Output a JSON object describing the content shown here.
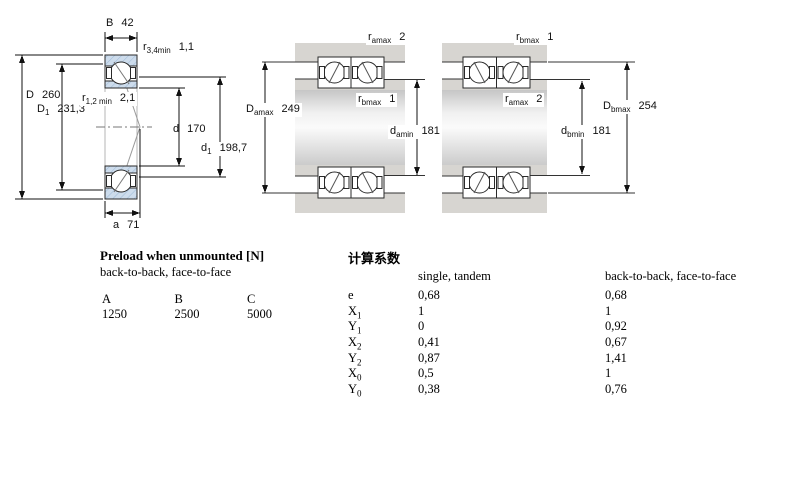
{
  "colors": {
    "ring_hatch_fill": "#cddcec",
    "ring_hatch_line": "#9cb9d6",
    "housing_gray": "#d7d5d1",
    "line_color": "#1a1a1a"
  },
  "left_drawing": {
    "dim_B": {
      "sym": "B",
      "value": "42"
    },
    "dim_r34": {
      "sym": "r",
      "sub": "3,4min",
      "value": "1,1"
    },
    "dim_D": {
      "sym": "D",
      "value": "260"
    },
    "dim_D1": {
      "sym": "D",
      "sub": "1",
      "value": "231,3"
    },
    "dim_r12": {
      "sym": "r",
      "sub": "1,2 min",
      "value": "2,1"
    },
    "dim_d": {
      "sym": "d",
      "value": "170"
    },
    "dim_d1": {
      "sym": "d",
      "sub": "1",
      "value": "198,7"
    },
    "dim_a": {
      "sym": "a",
      "value": "71"
    }
  },
  "middle_drawing": {
    "dim_ramax": {
      "sym": "r",
      "sub": "amax",
      "value": "2"
    },
    "dim_Damax": {
      "sym": "D",
      "sub": "amax",
      "value": "249"
    },
    "dim_rbmax": {
      "sym": "r",
      "sub": "bmax",
      "value": "1"
    },
    "dim_damin": {
      "sym": "d",
      "sub": "amin",
      "value": "181"
    }
  },
  "right_drawing": {
    "dim_rbmax": {
      "sym": "r",
      "sub": "bmax",
      "value": "1"
    },
    "dim_ramax": {
      "sym": "r",
      "sub": "amax",
      "value": "2"
    },
    "dim_Dbmax": {
      "sym": "D",
      "sub": "bmax",
      "value": "254"
    },
    "dim_dbmin": {
      "sym": "d",
      "sub": "bmin",
      "value": "181"
    }
  },
  "preload": {
    "title": "Preload when unmounted [N]",
    "subtitle": "back-to-back, face-to-face",
    "columns": [
      "A",
      "B",
      "C"
    ],
    "values": [
      "1250",
      "2500",
      "5000"
    ]
  },
  "factors": {
    "title": "计算系数",
    "col1_header": "single, tandem",
    "col2_header": "back-to-back, face-to-face",
    "rows": [
      {
        "sym": "e",
        "sub": "",
        "v1": "0,68",
        "v2": "0,68"
      },
      {
        "sym": "X",
        "sub": "1",
        "v1": "1",
        "v2": "1"
      },
      {
        "sym": "Y",
        "sub": "1",
        "v1": "0",
        "v2": "0,92"
      },
      {
        "sym": "X",
        "sub": "2",
        "v1": "0,41",
        "v2": "0,67"
      },
      {
        "sym": "Y",
        "sub": "2",
        "v1": "0,87",
        "v2": "1,41"
      },
      {
        "sym": "X",
        "sub": "0",
        "v1": "0,5",
        "v2": "1"
      },
      {
        "sym": "Y",
        "sub": "0",
        "v1": "0,38",
        "v2": "0,76"
      }
    ]
  }
}
